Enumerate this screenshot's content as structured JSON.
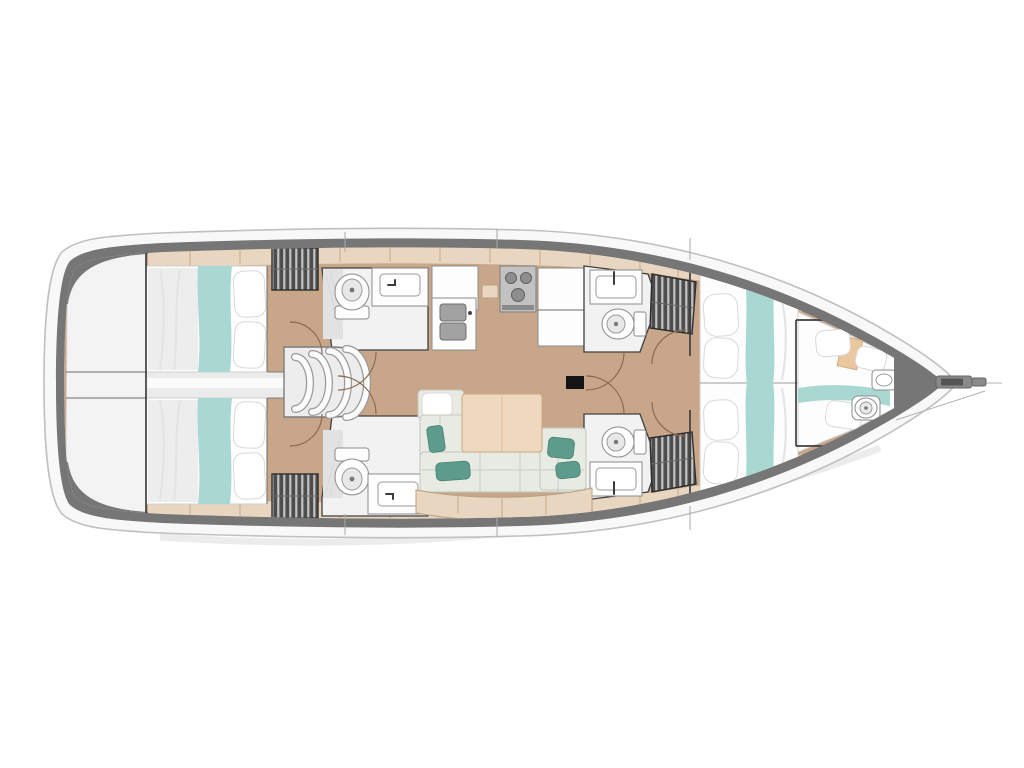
{
  "diagram": {
    "kind": "sailboat-interior-floor-plan",
    "orientation": "bow-right",
    "visible_text": ""
  },
  "colors": {
    "background": "#ffffff",
    "hull_white": "#f8f8f8",
    "hull_outline": "#c0c0c0",
    "deck_band_gray": "#767676",
    "transom_white": "#f3f3f3",
    "floor_wood": "#c7a68a",
    "deck_trim_beige": "#e9d6c0",
    "trim_line": "#c5ab8d",
    "room_white": "#f2f2f2",
    "fixture_white": "#fdfdfd",
    "fixture_outline": "#8c8c8c",
    "bed_linen": "#fdfdfd",
    "bed_shadow": "#ededed",
    "runner_teal": "#a9d8d2",
    "pillow_teal": "#5d9b8d",
    "settee_fabric": "#e8ebe4",
    "table_wood": "#eed9c0",
    "locker_dark": "#4d4d4d",
    "locker_stripe": "#d8d8d8",
    "wall_dark": "#3f3f3f",
    "divider_gray": "#ebebeb",
    "door_swing": "#8a6a50",
    "stove_gray": "#c2c2c2",
    "mast_black": "#141414",
    "headboard_tan": "#eac79e"
  }
}
